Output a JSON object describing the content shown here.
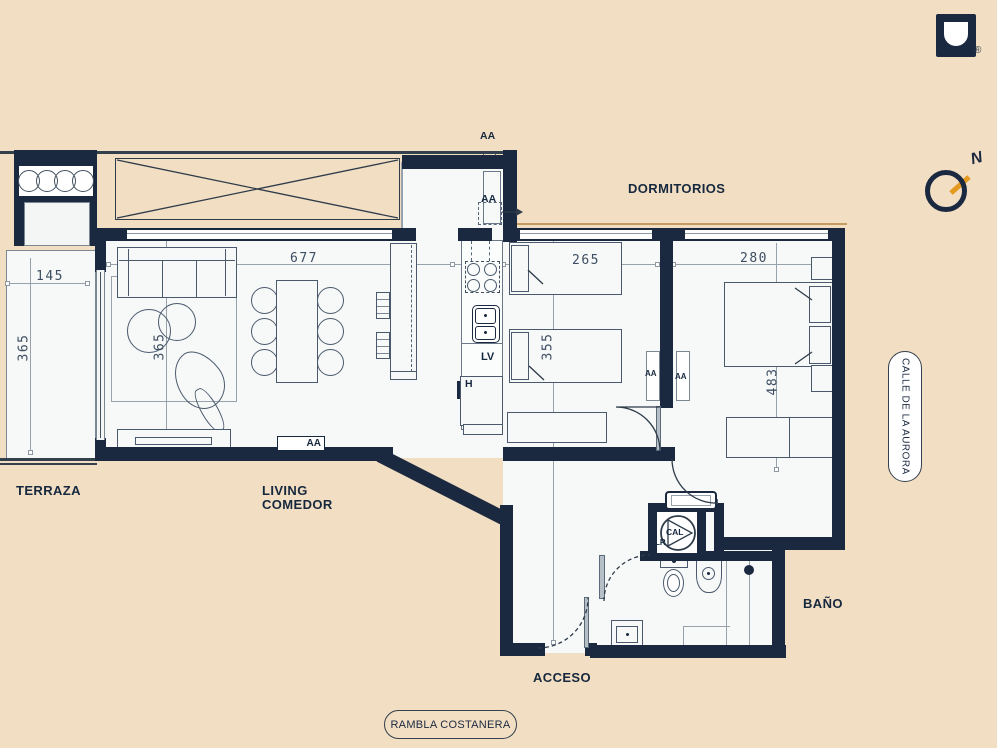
{
  "brand": {
    "registered": "®"
  },
  "compass": {
    "north": "N"
  },
  "labels": {
    "terraza": "TERRAZA",
    "living_line1": "LIVING",
    "living_line2": "COMEDOR",
    "dormitorios": "DORMITORIOS",
    "bano": "BAÑO",
    "acceso": "ACCESO"
  },
  "dims": {
    "terraza": {
      "width": "145",
      "height": "365"
    },
    "living": {
      "width": "677",
      "height": "365"
    },
    "bedroom1": {
      "width": "265",
      "height": "355"
    },
    "bedroom2": {
      "width": "280",
      "height": "483"
    }
  },
  "tags": {
    "aa": "AA",
    "lv": "LV",
    "h": "H",
    "lr": "LR",
    "cal": "CAL"
  },
  "streets": {
    "bottom": "RAMBLA COSTANERA",
    "right": "CALLE DE LA AURORA"
  },
  "colors": {
    "wall": "#1b2940",
    "accent": "#e39a1f",
    "floor": "#f7f8f8",
    "background": "#f2dec3"
  }
}
